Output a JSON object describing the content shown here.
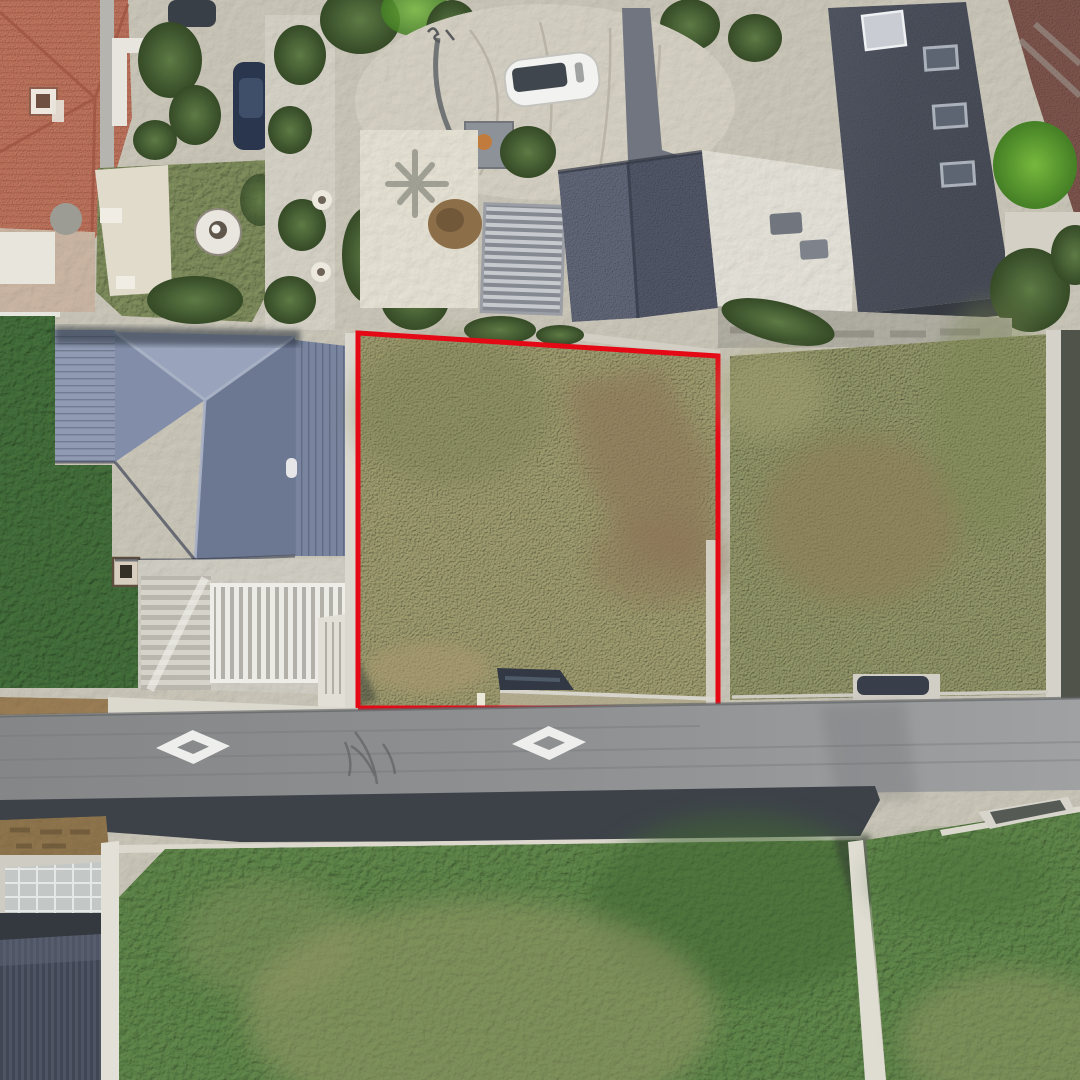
{
  "scene": {
    "type": "aerial-satellite-view",
    "description": "Overhead satellite photograph of a residential block; a vacant dry-grass land parcel in the centre is outlined in red, bordered below by a road with two hollow diamond pavement markings and green lawns.",
    "base_ground_color": "#ccc8ba"
  },
  "parcel": {
    "outline_color": "#e7000e",
    "outline_width": 5,
    "shape": "quadrilateral",
    "grass_color": "#9c996b",
    "soil_patch_color": "#8a7252",
    "status": "vacant lot"
  },
  "road": {
    "surface_color": "#8a8c8e",
    "marking_color": "#f0f0ee",
    "marking_type": "hollow-diamond",
    "marking_count": 2
  },
  "features": {
    "left_lawn_color": "#3e6b35",
    "right_parcel_grass_color": "#8e9263",
    "bottom_lawn_color": "#5b8345",
    "blue_roof_color": "#7f8ca8",
    "dark_roof_color": "#454a57",
    "terracotta_roof_color": "#c0725a",
    "concrete_color": "#d7d3c7",
    "white_car_color": "#f4f4f2",
    "dark_car_color": "#2c3440",
    "bright_tree_color": "#58a32c",
    "wood_wall_color": "#8e7348"
  }
}
